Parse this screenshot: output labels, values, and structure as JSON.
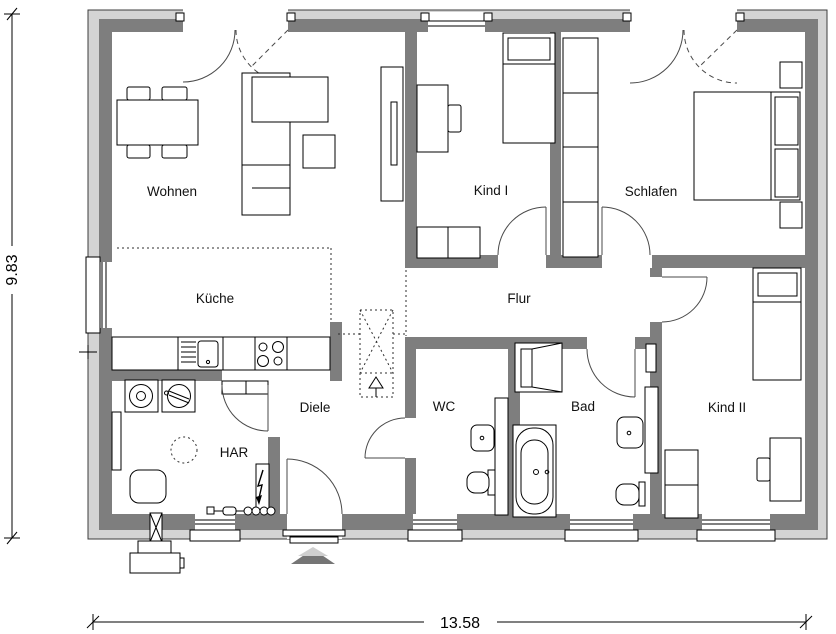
{
  "plan": {
    "type": "architectural-floor-plan",
    "rooms": [
      {
        "id": "wohnen",
        "label": "Wohnen"
      },
      {
        "id": "kueche",
        "label": "Küche"
      },
      {
        "id": "kind1",
        "label": "Kind I"
      },
      {
        "id": "schlafen",
        "label": "Schlafen"
      },
      {
        "id": "flur",
        "label": "Flur"
      },
      {
        "id": "diele",
        "label": "Diele"
      },
      {
        "id": "wc",
        "label": "WC"
      },
      {
        "id": "bad",
        "label": "Bad"
      },
      {
        "id": "kind2",
        "label": "Kind II"
      },
      {
        "id": "har",
        "label": "HAR"
      }
    ],
    "dimensions": {
      "total_width_m": "13.58",
      "total_height_m": "9.83"
    },
    "colors": {
      "wall": "#7e7e7e",
      "plinth": "#d4d4d4",
      "line": "#000000",
      "door_arc": "#4a4a4a"
    },
    "symbols": [
      "dining-table",
      "sofa",
      "side-table",
      "tv-sideboard",
      "single-bed",
      "double-bed",
      "wardrobe",
      "desk",
      "chair",
      "dresser",
      "nightstand",
      "kitchen-counter",
      "kitchen-sink",
      "stove",
      "washing-machine",
      "dryer",
      "boiler",
      "storage-tank",
      "shelf",
      "electrical-panel",
      "house-connection-strip",
      "wall-duct",
      "heat-pump-outdoor-unit",
      "shower",
      "bathtub",
      "washbasin",
      "toilet",
      "installation-wall",
      "chimney",
      "entrance-arrow",
      "door-swing",
      "window",
      "dimension-line"
    ]
  }
}
